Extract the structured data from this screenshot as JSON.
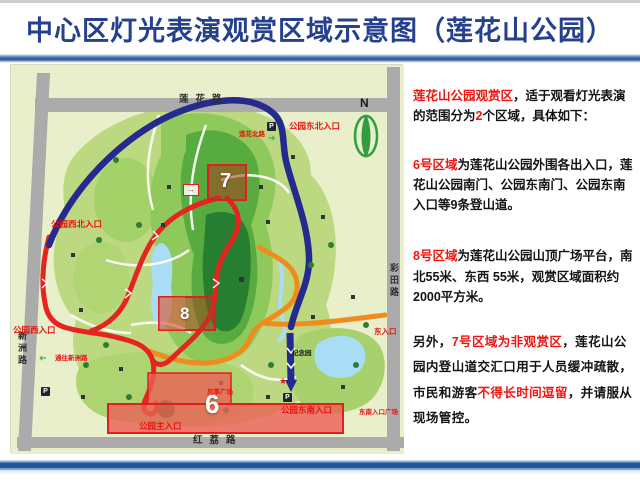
{
  "header": {
    "title": "中心区灯光表演观赏区域示意图（莲花山公园）"
  },
  "panel": {
    "p1": {
      "s1": "莲花山公园观赏区",
      "s2": "，适于观看灯光表演的范围分为",
      "s3": "2",
      "s4": "个区域，具体如下："
    },
    "p2": {
      "s1": "6号区域",
      "s2": "为莲花山公园外围各出入口，莲花山公园南门、公园东南门、公园东南入口等9条登山道。"
    },
    "p3": {
      "s1": "8号区域",
      "s2": "为莲花山公园山顶广场平台，南北55米、东西 55米，观赏区域面积约2000平方米。"
    },
    "p4": {
      "s1": "另外，",
      "s2": "7号区域为非观赏区",
      "s3": "，莲花山公园内登山道交汇口用于人员缓冲疏散，市民和游客",
      "s4": "不得长时间逗留",
      "s5": "，并请服从现场管控。"
    }
  },
  "map": {
    "roads": {
      "top": "莲花路",
      "left": "新洲路",
      "right": "彩田路",
      "bottom": "红荔路"
    },
    "compass_n": "N",
    "labels": {
      "ne_entrance": "公园东北入口",
      "north_road": "莲花北路",
      "nw_entrance": "公园西北入口",
      "w_entrance": "公园西入口",
      "to_xinzhou": "通往新洲路",
      "main_entrance": "公园主入口",
      "se_entrance": "公园东南入口",
      "se_plaza": "东南入口广场",
      "e_entrance": "东入口",
      "memorial": "纪念园",
      "kite_square": "风筝广场"
    },
    "zones": {
      "z6": "6",
      "z7": "7",
      "z8": "8"
    },
    "icons": {
      "parking": "P",
      "arrow": "➔",
      "small_arrow": "→",
      "star": "★"
    },
    "colors": {
      "accent_red": "#e6231e",
      "navy_path": "#252a8f",
      "orange_path": "#f08c1e",
      "road_gray": "#ababab",
      "zone_fill": "#f08a7e",
      "title_blue": "#24408f"
    }
  }
}
